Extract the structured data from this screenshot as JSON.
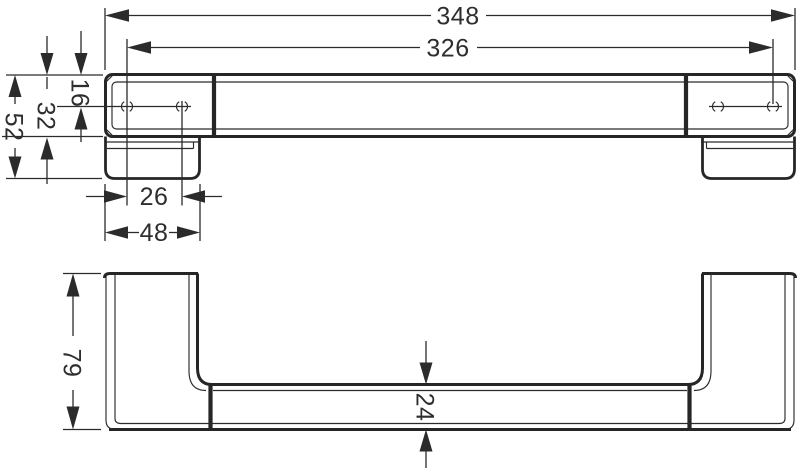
{
  "drawing": {
    "colors": {
      "ink": "#2b2b2b",
      "background": "#ffffff"
    },
    "dims": {
      "overall_width": "348",
      "hole_span": "326",
      "end_height": "52",
      "body_height": "32",
      "hole_offset": "16",
      "hole_pitch": "26",
      "base_width": "48",
      "overall_depth": "79",
      "rail_depth": "24"
    }
  }
}
